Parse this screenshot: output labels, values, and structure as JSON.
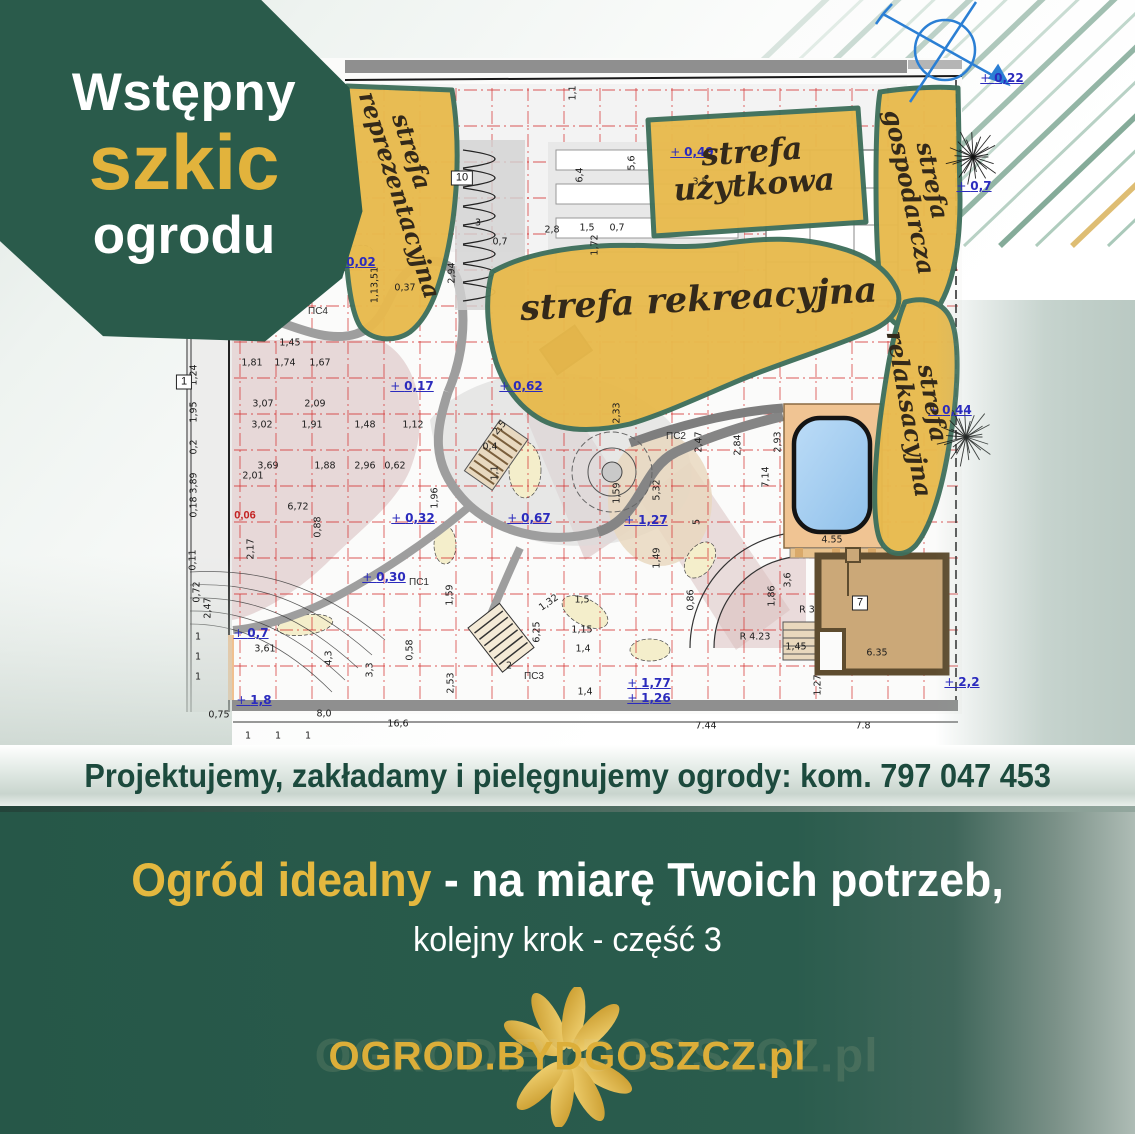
{
  "colors": {
    "dark_green": "#2A5B4B",
    "accent_gold": "#E2B33C",
    "zone_gold": "#E8BA4D",
    "zone_outline": "#3E6F5B",
    "grid_red": "#D42F2F",
    "elevation_blue": "#2B2BBD",
    "pool_blue": "#A9D2F3",
    "deck_tan": "#F0C493",
    "house_brown": "#CBA878",
    "compass_blue": "#2B7FD4"
  },
  "badge": {
    "line1": "Wstępny",
    "line2": "szkic",
    "line3": "ogrodu"
  },
  "plan": {
    "zones": [
      {
        "id": "reprezentacyjna",
        "label": "strefa reprezentacyjna"
      },
      {
        "id": "uzytkowa",
        "label": "strefa użytkowa"
      },
      {
        "id": "gospodarcza",
        "label": "strefa gospodarcza"
      },
      {
        "id": "rekreacyjna",
        "label": "strefa rekreacyjna"
      },
      {
        "id": "relaksacyjna",
        "label": "strefa relaksacyjna"
      }
    ],
    "elevations": [
      {
        "t": "0,22",
        "x": 1002,
        "y": 78
      },
      {
        "t": "0,7",
        "x": 974,
        "y": 186
      },
      {
        "t": "0,49",
        "x": 692,
        "y": 152
      },
      {
        "t": "0,02",
        "x": 354,
        "y": 262
      },
      {
        "t": "0,62",
        "x": 521,
        "y": 386
      },
      {
        "t": "0,17",
        "x": 412,
        "y": 386
      },
      {
        "t": "0,32",
        "x": 413,
        "y": 518
      },
      {
        "t": "0,30",
        "x": 384,
        "y": 577
      },
      {
        "t": "0,67",
        "x": 529,
        "y": 518
      },
      {
        "t": "1,27",
        "x": 646,
        "y": 520
      },
      {
        "t": "0,7",
        "x": 251,
        "y": 633
      },
      {
        "t": "1,8",
        "x": 254,
        "y": 700
      },
      {
        "t": "1,77",
        "x": 649,
        "y": 683
      },
      {
        "t": "1,26",
        "x": 649,
        "y": 698
      },
      {
        "t": "2,2",
        "x": 962,
        "y": 682
      },
      {
        "t": "0,44",
        "x": 950,
        "y": 410
      }
    ],
    "dimensions": [
      {
        "t": "1,45",
        "x": 290,
        "y": 343
      },
      {
        "t": "1,81",
        "x": 252,
        "y": 363
      },
      {
        "t": "1,74",
        "x": 285,
        "y": 363
      },
      {
        "t": "1,67",
        "x": 320,
        "y": 363
      },
      {
        "t": "3,07",
        "x": 263,
        "y": 404
      },
      {
        "t": "2,09",
        "x": 315,
        "y": 404
      },
      {
        "t": "3,02",
        "x": 262,
        "y": 425
      },
      {
        "t": "1,91",
        "x": 312,
        "y": 425
      },
      {
        "t": "1,48",
        "x": 365,
        "y": 425
      },
      {
        "t": "1,12",
        "x": 413,
        "y": 425
      },
      {
        "t": "3,69",
        "x": 268,
        "y": 466
      },
      {
        "t": "2,01",
        "x": 253,
        "y": 476
      },
      {
        "t": "1,88",
        "x": 325,
        "y": 466
      },
      {
        "t": "2,96",
        "x": 365,
        "y": 466
      },
      {
        "t": "0,62",
        "x": 395,
        "y": 466
      },
      {
        "t": "6,72",
        "x": 298,
        "y": 507
      },
      {
        "t": "0,88",
        "x": 318,
        "y": 527,
        "r": -90
      },
      {
        "t": "2,17",
        "x": 251,
        "y": 549,
        "r": -90
      },
      {
        "t": "3,61",
        "x": 265,
        "y": 649
      },
      {
        "t": "4,3",
        "x": 329,
        "y": 658,
        "r": -90
      },
      {
        "t": "3,3",
        "x": 370,
        "y": 670,
        "r": -90
      },
      {
        "t": "0,58",
        "x": 410,
        "y": 650,
        "r": -90
      },
      {
        "t": "1,59",
        "x": 450,
        "y": 595,
        "r": -90
      },
      {
        "t": "2,53",
        "x": 451,
        "y": 683,
        "r": -90
      },
      {
        "t": "6,25",
        "x": 537,
        "y": 632,
        "r": -90
      },
      {
        "t": "1,15",
        "x": 582,
        "y": 630
      },
      {
        "t": "1,4",
        "x": 583,
        "y": 649
      },
      {
        "t": "1,4",
        "x": 585,
        "y": 692
      },
      {
        "t": "1,5",
        "x": 582,
        "y": 600
      },
      {
        "t": "1,32",
        "x": 549,
        "y": 603,
        "r": -35
      },
      {
        "t": "2",
        "x": 509,
        "y": 666
      },
      {
        "t": "0,75",
        "x": 219,
        "y": 715
      },
      {
        "t": "8,0",
        "x": 324,
        "y": 714
      },
      {
        "t": "16,6",
        "x": 398,
        "y": 724
      },
      {
        "t": "7.44",
        "x": 706,
        "y": 726
      },
      {
        "t": "7.8",
        "x": 863,
        "y": 726
      },
      {
        "t": "1,27",
        "x": 818,
        "y": 685,
        "r": -90
      },
      {
        "t": "6.35",
        "x": 877,
        "y": 653
      },
      {
        "t": "1,45",
        "x": 796,
        "y": 647
      },
      {
        "t": "2,93",
        "x": 778,
        "y": 442,
        "r": -90
      },
      {
        "t": "7,14",
        "x": 766,
        "y": 477,
        "r": -90
      },
      {
        "t": "4.55",
        "x": 832,
        "y": 540
      },
      {
        "t": "3,6",
        "x": 788,
        "y": 580,
        "r": -90
      },
      {
        "t": "1,86",
        "x": 772,
        "y": 596,
        "r": -90
      },
      {
        "t": "5,32",
        "x": 657,
        "y": 490,
        "r": -90
      },
      {
        "t": "2,8",
        "x": 552,
        "y": 230
      },
      {
        "t": "1,5",
        "x": 587,
        "y": 228
      },
      {
        "t": "0,7",
        "x": 617,
        "y": 228
      },
      {
        "t": "3",
        "x": 478,
        "y": 223
      },
      {
        "t": "0,7",
        "x": 500,
        "y": 242
      },
      {
        "t": "6,4",
        "x": 580,
        "y": 175,
        "r": -90
      },
      {
        "t": "5,6",
        "x": 632,
        "y": 163,
        "r": -90
      },
      {
        "t": "1,1",
        "x": 573,
        "y": 93,
        "r": -90
      },
      {
        "t": "2,94",
        "x": 452,
        "y": 273,
        "r": -90
      },
      {
        "t": "0,37",
        "x": 405,
        "y": 288
      },
      {
        "t": "1,72",
        "x": 595,
        "y": 245,
        "r": -90
      },
      {
        "t": "0,72",
        "x": 197,
        "y": 592,
        "r": -90
      },
      {
        "t": "2,47",
        "x": 208,
        "y": 608,
        "r": -90
      },
      {
        "t": "1,24",
        "x": 194,
        "y": 375,
        "r": -90
      },
      {
        "t": "1,95",
        "x": 194,
        "y": 412,
        "r": -90
      },
      {
        "t": "0,2",
        "x": 194,
        "y": 447,
        "r": -90
      },
      {
        "t": "3,89",
        "x": 194,
        "y": 483,
        "r": -90
      },
      {
        "t": "0,18",
        "x": 194,
        "y": 507,
        "r": -90
      },
      {
        "t": "0,11",
        "x": 193,
        "y": 560,
        "r": -90
      },
      {
        "t": "1,13,51",
        "x": 375,
        "y": 285,
        "r": -90
      },
      {
        "t": "0,4",
        "x": 490,
        "y": 447
      },
      {
        "t": "1,1",
        "x": 495,
        "y": 473,
        "r": -90
      },
      {
        "t": "2,5",
        "x": 500,
        "y": 428,
        "r": -50
      },
      {
        "t": "1,96",
        "x": 435,
        "y": 498,
        "r": -90
      },
      {
        "t": "1,59",
        "x": 617,
        "y": 493,
        "r": -90
      },
      {
        "t": "2,33",
        "x": 617,
        "y": 413,
        "r": -90
      },
      {
        "t": "2,47",
        "x": 699,
        "y": 442,
        "r": -90
      },
      {
        "t": "2,84",
        "x": 738,
        "y": 445,
        "r": -90
      },
      {
        "t": "5",
        "x": 697,
        "y": 522,
        "r": -90
      },
      {
        "t": "1,49",
        "x": 657,
        "y": 558,
        "r": -90
      },
      {
        "t": "0,86",
        "x": 691,
        "y": 600,
        "r": -90
      },
      {
        "t": "R 3",
        "x": 807,
        "y": 610
      },
      {
        "t": "R 4.23",
        "x": 755,
        "y": 637
      },
      {
        "t": "1",
        "x": 198,
        "y": 637
      },
      {
        "t": "1",
        "x": 198,
        "y": 657
      },
      {
        "t": "1",
        "x": 198,
        "y": 677
      },
      {
        "t": "1",
        "x": 248,
        "y": 736
      },
      {
        "t": "1",
        "x": 278,
        "y": 736
      },
      {
        "t": "1",
        "x": 308,
        "y": 736
      },
      {
        "t": "3,5",
        "x": 700,
        "y": 182
      }
    ],
    "ps_labels": [
      {
        "t": "ПС1",
        "x": 419,
        "y": 583
      },
      {
        "t": "ПС2",
        "x": 676,
        "y": 437
      },
      {
        "t": "ПС3",
        "x": 534,
        "y": 677
      },
      {
        "t": "ПС4",
        "x": 318,
        "y": 312
      }
    ],
    "boxed_labels": [
      {
        "t": "1",
        "x": 184,
        "y": 382
      },
      {
        "t": "10",
        "x": 462,
        "y": 178
      },
      {
        "t": "7",
        "x": 860,
        "y": 603
      }
    ],
    "red_labels": [
      {
        "t": "0,06",
        "x": 245,
        "y": 516
      }
    ]
  },
  "contact_bar": {
    "text": "Projektujemy, zakładamy i pielęgnujemy ogrody: kom. 797 047 453"
  },
  "footer": {
    "headline_gold": "Ogród idealny",
    "headline_rest": " - na miarę Twoich potrzeb,",
    "subline": "kolejny krok - część 3",
    "logo_text": "OGROD.BYDGOSZCZ.pl"
  }
}
